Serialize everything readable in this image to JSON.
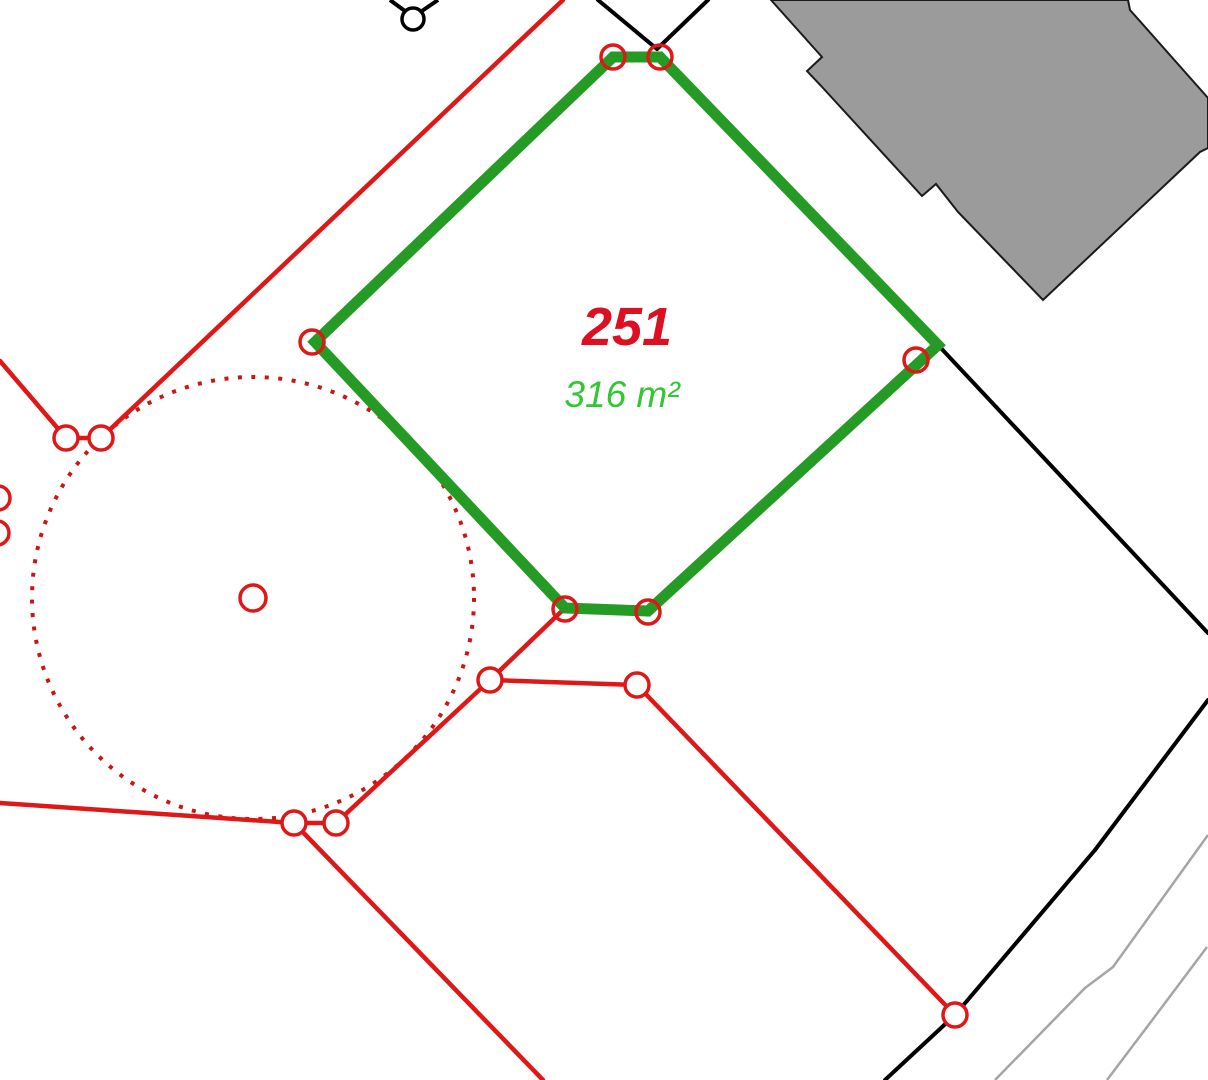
{
  "map": {
    "background": "#ffffff",
    "parcel": {
      "number": "251",
      "area": "316 m²",
      "number_color": "#dc1020",
      "area_color": "#2fc832",
      "outline_color": "#259b25",
      "points": "613,57 660,57 938,345 648,611 565,608 315,342",
      "number_pos": {
        "x": 627,
        "y": 345
      },
      "area_pos": {
        "x": 622,
        "y": 407
      }
    },
    "colors": {
      "red": "#e01717",
      "black": "#000000",
      "gray_line": "#a5a5a5",
      "building_fill": "#9b9b9b",
      "building_stroke": "#1a1a1a",
      "dotted_red": "#cc1414"
    },
    "stroke": {
      "red": 4.5,
      "black": 4,
      "green": 11,
      "gray": 2.5,
      "marker": 3.5,
      "dotted": 4,
      "building": 2,
      "survey": 3.5
    },
    "dotted_circle": {
      "cx": 253,
      "cy": 598,
      "r": 221,
      "dash": "4 9.5"
    },
    "center_point_marker": {
      "cx": 253,
      "cy": 598,
      "r": 13
    },
    "red_lines": [
      [
        563,
        0,
        101,
        438
      ],
      [
        101,
        438,
        66,
        438
      ],
      [
        66,
        438,
        0,
        361
      ],
      [
        565,
        608,
        490,
        680
      ],
      [
        490,
        680,
        637,
        685
      ],
      [
        637,
        685,
        955,
        1015
      ],
      [
        490,
        680,
        336,
        823
      ],
      [
        336,
        823,
        294,
        823
      ],
      [
        294,
        823,
        0,
        803
      ],
      [
        294,
        823,
        543,
        1080
      ]
    ],
    "black_lines": [
      [
        598,
        0,
        657,
        49
      ],
      [
        708,
        0,
        657,
        49
      ],
      [
        938,
        345,
        1208,
        633
      ],
      [
        1208,
        700,
        1095,
        850
      ],
      [
        1095,
        850,
        955,
        1015
      ],
      [
        955,
        1015,
        885,
        1080
      ]
    ],
    "gray_polylines": [
      [
        [
          1208,
          835
        ],
        [
          1190,
          860
        ],
        [
          1113,
          967
        ],
        [
          1085,
          988
        ],
        [
          995,
          1080
        ]
      ],
      [
        [
          1207,
          947
        ],
        [
          1147,
          1027
        ],
        [
          1107,
          1080
        ]
      ]
    ],
    "vertex_markers_red": [
      [
        101,
        438
      ],
      [
        66,
        438
      ],
      [
        490,
        680
      ],
      [
        637,
        685
      ],
      [
        294,
        823
      ],
      [
        336,
        823
      ],
      [
        955,
        1015
      ],
      [
        -2,
        498
      ],
      [
        -3,
        533
      ]
    ],
    "vertex_markers_on_parcel": [
      [
        613,
        57
      ],
      [
        660,
        57
      ],
      [
        916,
        360
      ],
      [
        648,
        612
      ],
      [
        565,
        609
      ],
      [
        312,
        342
      ]
    ],
    "marker_radius": 12,
    "survey_point": {
      "circle": {
        "cx": 413,
        "cy": 19,
        "r": 11
      },
      "lines": [
        [
          390,
          0,
          409,
          14
        ],
        [
          438,
          0,
          419,
          13
        ]
      ]
    },
    "building": {
      "points": "771,0 822,57 807,71 823,88 922,196 936,184 958,212 1043,300 1200,152 1208,148 1208,98 1130,10 1128,0"
    }
  }
}
